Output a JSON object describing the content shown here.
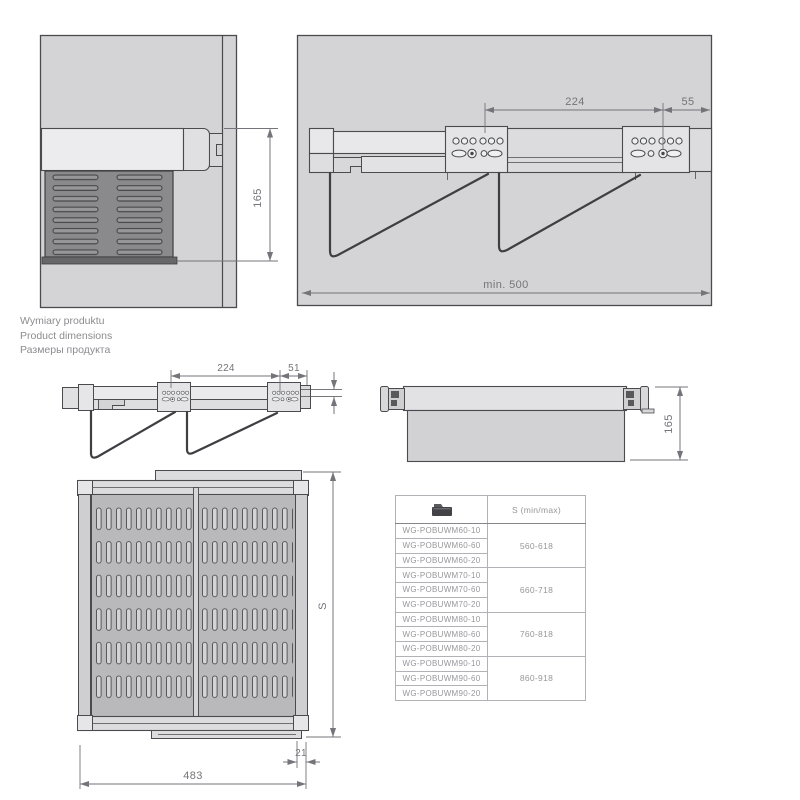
{
  "titles": {
    "pl": "Wymiary produktu",
    "en": "Product dimensions",
    "ru": "Размеры продукта"
  },
  "views": {
    "cabinet_section": {
      "height_label": "165"
    },
    "wall_rail": {
      "span_label": "224",
      "offset_label": "55",
      "depth_label": "min. 500"
    },
    "front_rail": {
      "span_label": "224",
      "offset_label": "51"
    },
    "basket_side": {
      "height_label": "165"
    },
    "basket_top": {
      "width_label": "483",
      "depth_label": "S",
      "offset_label": "21"
    }
  },
  "table": {
    "header": {
      "product_col_icon": "drawer-folder-icon",
      "size_col": "S (min/max)"
    },
    "groups": [
      {
        "codes": [
          "WG-POBUWM60-10",
          "WG-POBUWM60-60",
          "WG-POBUWM60-20"
        ],
        "range": "560-618"
      },
      {
        "codes": [
          "WG-POBUWM70-10",
          "WG-POBUWM70-60",
          "WG-POBUWM70-20"
        ],
        "range": "660-718"
      },
      {
        "codes": [
          "WG-POBUWM80-10",
          "WG-POBUWM80-60",
          "WG-POBUWM80-20"
        ],
        "range": "760-818"
      },
      {
        "codes": [
          "WG-POBUWM90-10",
          "WG-POBUWM90-60",
          "WG-POBUWM90-20"
        ],
        "range": "860-918"
      }
    ]
  },
  "colors": {
    "background": "#ffffff",
    "panel_fill": "#d4d4d6",
    "light_fill": "#e8e8ea",
    "vent_fill": "#8a8a8d",
    "basket_panel_fill": "#b9b9bb",
    "drawing_line": "#4b4b4f",
    "dimension_line": "#74747a",
    "caption_text": "#8c8c90",
    "table_text": "#97979b",
    "table_border": "#85858a",
    "icon_dark": "#434347"
  }
}
